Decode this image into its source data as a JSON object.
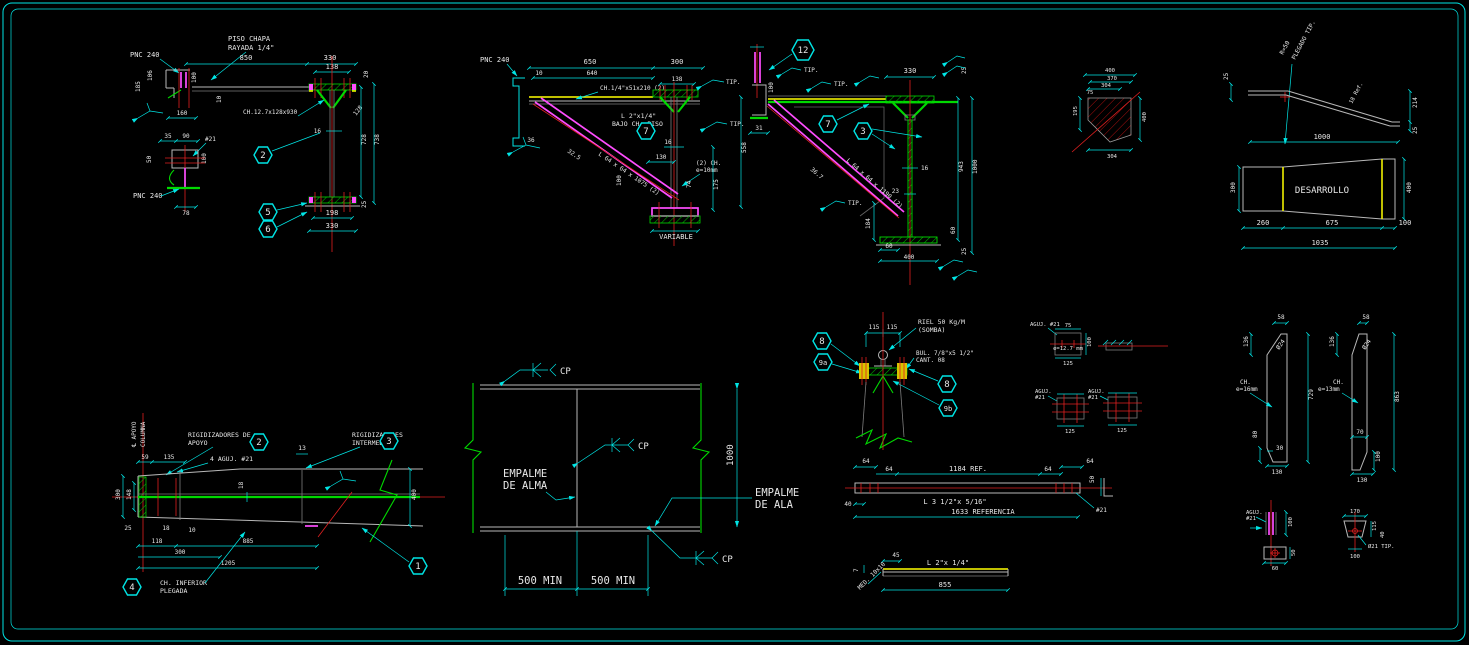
{
  "sheet": {
    "bg": "#000000",
    "frame_color": "#00e5e5"
  },
  "palette": {
    "cyan": "#00e5e5",
    "green": "#00d900",
    "red": "#ff2a2a",
    "magenta": "#ff4dff",
    "yellow": "#ffff00",
    "gray": "#b8b8b8",
    "white": "#e8e8e8"
  },
  "balloons": {
    "b1": "1",
    "b2": "2",
    "b3": "3",
    "b4": "4",
    "b5": "5",
    "b6": "6",
    "b7": "7",
    "b8": "8",
    "b9a": "9a",
    "b9b": "9b",
    "b12": "12"
  },
  "d1": {
    "piso1": "PISO CHAPA",
    "piso2": "RAYADA 1/4\"",
    "pnc_top": "PNC 240",
    "pnc_bot": "PNC 240",
    "ch_note": "CH.12.7x128x930",
    "dims": {
      "span": "850",
      "top": "330",
      "f138": "138",
      "d106": "106",
      "d185": "185",
      "d100": "100",
      "d160": "160",
      "d10": "10",
      "d20": "20",
      "web16": "16",
      "diag128": "128",
      "h728": "728",
      "h738": "738",
      "d25": "25",
      "d198": "198",
      "bot330": "330",
      "s35": "35",
      "s90": "90",
      "hole": "#21",
      "s50": "50",
      "s100": "100",
      "s78": "78"
    }
  },
  "d2": {
    "pnc": "PNC 240",
    "ch_note": "CH.1/4\"x51x210 (2)",
    "l1": "L 2\"x1/4\"",
    "l2": "BAJO CH. PISO",
    "strut": "L 64 x 64 x 1075 (2)",
    "ang": "32.5",
    "ch2a": "(2) CH.",
    "ch2b": "e=10mm",
    "variable": "VARIABLE",
    "tip1": "TIP.",
    "tip2": "TIP.",
    "dims": {
      "span": "650",
      "d10": "10",
      "d640": "640",
      "d300": "300",
      "d138": "138",
      "d36": "36",
      "web16": "16",
      "d130": "130",
      "d74": "74",
      "d175": "175",
      "d558": "558",
      "d100": "100"
    }
  },
  "d3": {
    "strut": "L 64 x 64 x 1190 (2)",
    "ang": "36.7",
    "tip1": "TIP.",
    "tip2": "TIP.",
    "tip3": "TIP.",
    "dims": {
      "d330": "330",
      "d100": "100",
      "d31": "31",
      "web16": "16",
      "d23": "23",
      "d184": "184",
      "d943": "943",
      "d1000": "1000",
      "d25t": "25",
      "d60r": "60",
      "d25b": "25",
      "d60": "60",
      "d400": "400"
    }
  },
  "d4": {
    "dims": {
      "t400": "400",
      "t370": "370",
      "t304": "304",
      "t75": "75",
      "l195": "195",
      "r400": "400",
      "b304": "304"
    }
  },
  "d5": {
    "nota": "R=50",
    "notb": "PLEGADO TIP.",
    "ref": "18 Ref.",
    "desarrollo": "DESARROLLO",
    "dims": {
      "d25l": "25",
      "d1000": "1000",
      "d214": "214",
      "d25r": "25",
      "d300": "300",
      "d400": "400",
      "d260": "260",
      "d675": "675",
      "d100": "100",
      "d1035": "1035"
    }
  },
  "d6": {
    "cl1": "℄ APOYO",
    "cl2": "COLUMNA",
    "rig1": "RIGIDIZADORES DE",
    "rig2": "APOYO",
    "aguj": "4 AGUJ. #21",
    "rin1": "RIGIDIZADORES",
    "rin2": "INTERMEDIOS",
    "chinf1": "CH. INFERIOR",
    "chinf2": "PLEGADA",
    "dims": {
      "d59": "59",
      "d135": "135",
      "d13": "13",
      "d18w": "18",
      "v300": "300",
      "v148": "148",
      "d25": "25",
      "d18": "18",
      "d10": "10",
      "d118": "118",
      "d300": "300",
      "d885": "885",
      "d1205": "1205",
      "d400": "400"
    }
  },
  "d7": {
    "alma1": "EMPALME",
    "alma2": "DE ALMA",
    "ala1": "EMPALME",
    "ala2": "DE ALA",
    "cp1": "CP",
    "cp2": "CP",
    "cp3": "CP",
    "dims": {
      "d1000": "1000",
      "min1": "500 MIN",
      "min2": "500 MIN"
    }
  },
  "d8": {
    "riel1": "RIEL 50 Kg/M",
    "riel2": "(SOMBA)",
    "bul1": "BUL. 7/8\"x5 1/2\"",
    "bul2": "CANT. 08",
    "dims": {
      "d115a": "115",
      "d115b": "115"
    }
  },
  "d9": {
    "p1_label": "AGUJ. #21",
    "p1_e": "e=12.7 mm",
    "p1_b": "125",
    "p1_r": "100",
    "p1_t": "75",
    "p3_l1": "AGUJ.",
    "p3_l2": "#21",
    "p3_b": "125",
    "p4_l1": "AGUJ.",
    "p4_l2": "#21",
    "p4_b": "125"
  },
  "d10": {
    "lch1": "CH.",
    "lch2": "e=16mm",
    "rch1": "CH.",
    "rch2": "e=13mm",
    "dims": {
      "l58": "58",
      "l136": "136",
      "l24": "Ø24",
      "l729": "729",
      "l80": "80",
      "l30": "30",
      "l130": "130",
      "r58": "58",
      "r136": "136",
      "r24": "Ø24",
      "r863": "863",
      "r70": "70",
      "r100": "100",
      "r130": "130"
    }
  },
  "d11": {
    "bar1": "L 3 1/2\"x 5/16\"",
    "bar2": "L 2\"x 1/4\"",
    "ref1": "1184 REF.",
    "ref2": "1633 REFERENCIA",
    "hole": "#21",
    "med": "MED. 10x10",
    "dims": {
      "a64": "64",
      "b64": "64",
      "c64": "64",
      "e64": "64",
      "d40": "40",
      "d50": "50",
      "d45": "45",
      "d7": "7",
      "d855": "855"
    }
  },
  "d12": {
    "l1": "AGUJ.",
    "l2": "#21",
    "note": "Ø21 TIP.",
    "dims": {
      "l100": "100",
      "l50": "50",
      "l60": "60",
      "r170": "170",
      "r115": "115",
      "r40": "40",
      "r100": "100"
    }
  }
}
